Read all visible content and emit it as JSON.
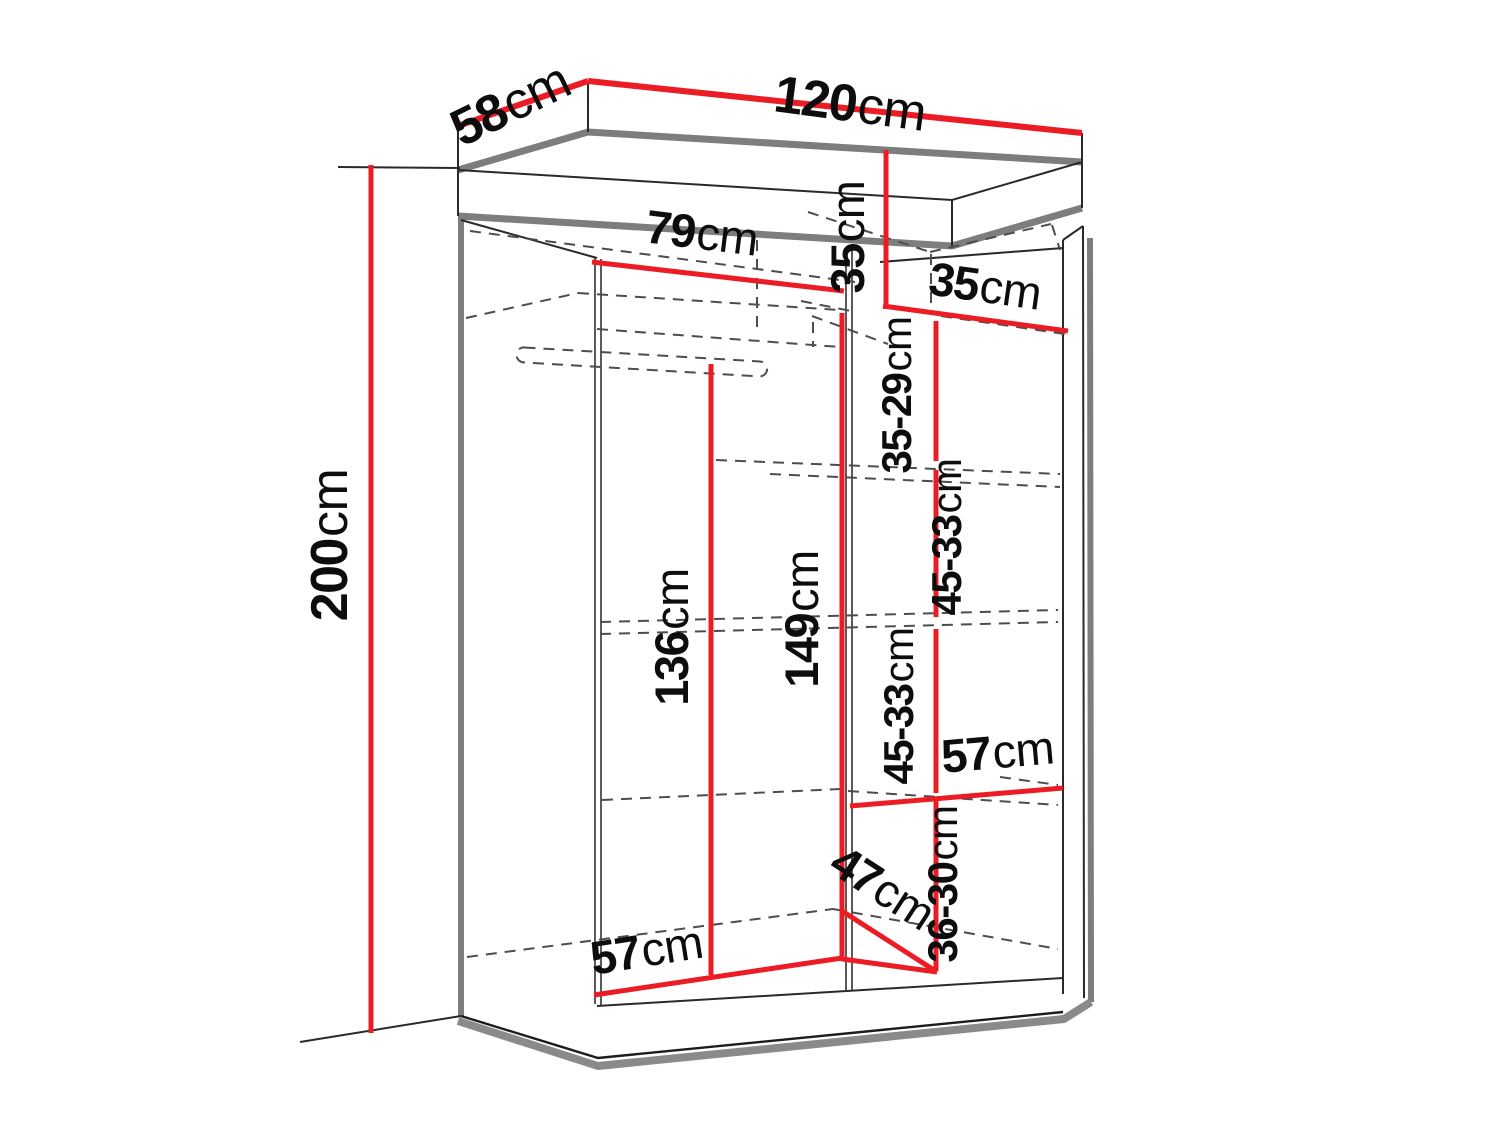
{
  "figure": {
    "kind": "furniture dimension diagram",
    "subject": "two-door sliding wardrobe interior measurements",
    "unit": "cm"
  },
  "colors": {
    "dimension_line": "#ec1c24",
    "outline": "#1c1c1c",
    "panel_edge_gray": "#7d7d7d",
    "dashed_hidden_edge": "#4d4d4d",
    "background": "#ffffff",
    "label_text": "#0d0d0d"
  },
  "dims": {
    "depth_top": {
      "num": "58",
      "unit": "cm"
    },
    "width_top": {
      "num": "120",
      "unit": "cm"
    },
    "height_left": {
      "num": "200",
      "unit": "cm"
    },
    "top_shelf_width": {
      "num": "79",
      "unit": "cm"
    },
    "cubby_height": {
      "num": "35",
      "unit": "cm"
    },
    "cubby_width": {
      "num": "35",
      "unit": "cm"
    },
    "gap_top_right": {
      "num": "35-29",
      "unit": "cm"
    },
    "gap_upper_right": {
      "num": "45-33",
      "unit": "cm"
    },
    "gap_lower_right": {
      "num": "45-33",
      "unit": "cm"
    },
    "left_clear_height": {
      "num": "136",
      "unit": "cm"
    },
    "mid_clear_height": {
      "num": "149",
      "unit": "cm"
    },
    "right_shelf_width": {
      "num": "57",
      "unit": "cm"
    },
    "gap_bottom_right": {
      "num": "36-30",
      "unit": "cm"
    },
    "bottom_depth": {
      "num": "47",
      "unit": "cm"
    },
    "bottom_left_width": {
      "num": "57",
      "unit": "cm"
    }
  }
}
